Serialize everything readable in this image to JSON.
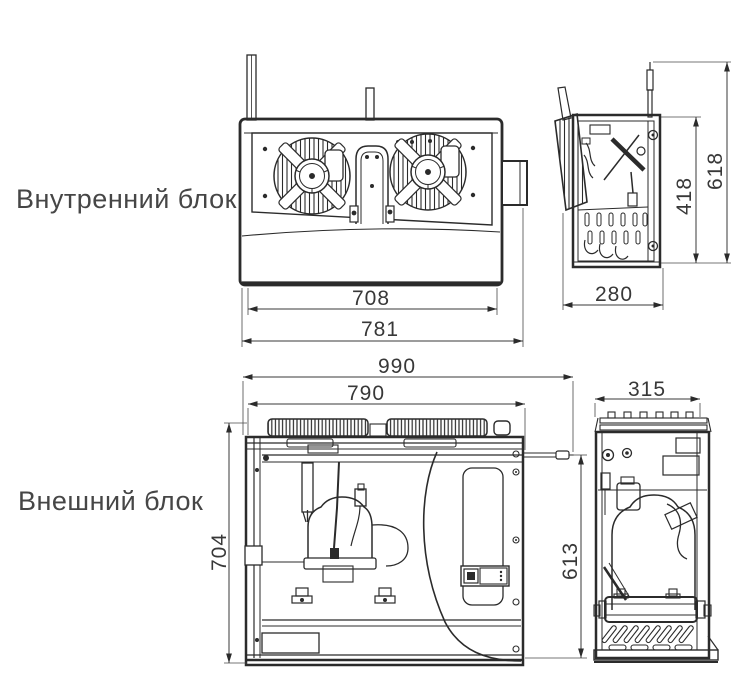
{
  "page": {
    "background": "#ffffff",
    "line_color": "#2b2b2b",
    "label_color": "#464646"
  },
  "labels": {
    "indoor_unit": "Внутренний блок",
    "outdoor_unit": "Внешний блок"
  },
  "dimensions": {
    "indoor_front": {
      "inner_width": "708",
      "overall_width": "781"
    },
    "indoor_side": {
      "depth": "280",
      "body_height": "418",
      "overall_height": "618"
    },
    "outdoor_front": {
      "overall_width": "990",
      "body_width": "790",
      "height": "704",
      "port_height": "613"
    },
    "outdoor_side": {
      "depth": "315"
    }
  }
}
